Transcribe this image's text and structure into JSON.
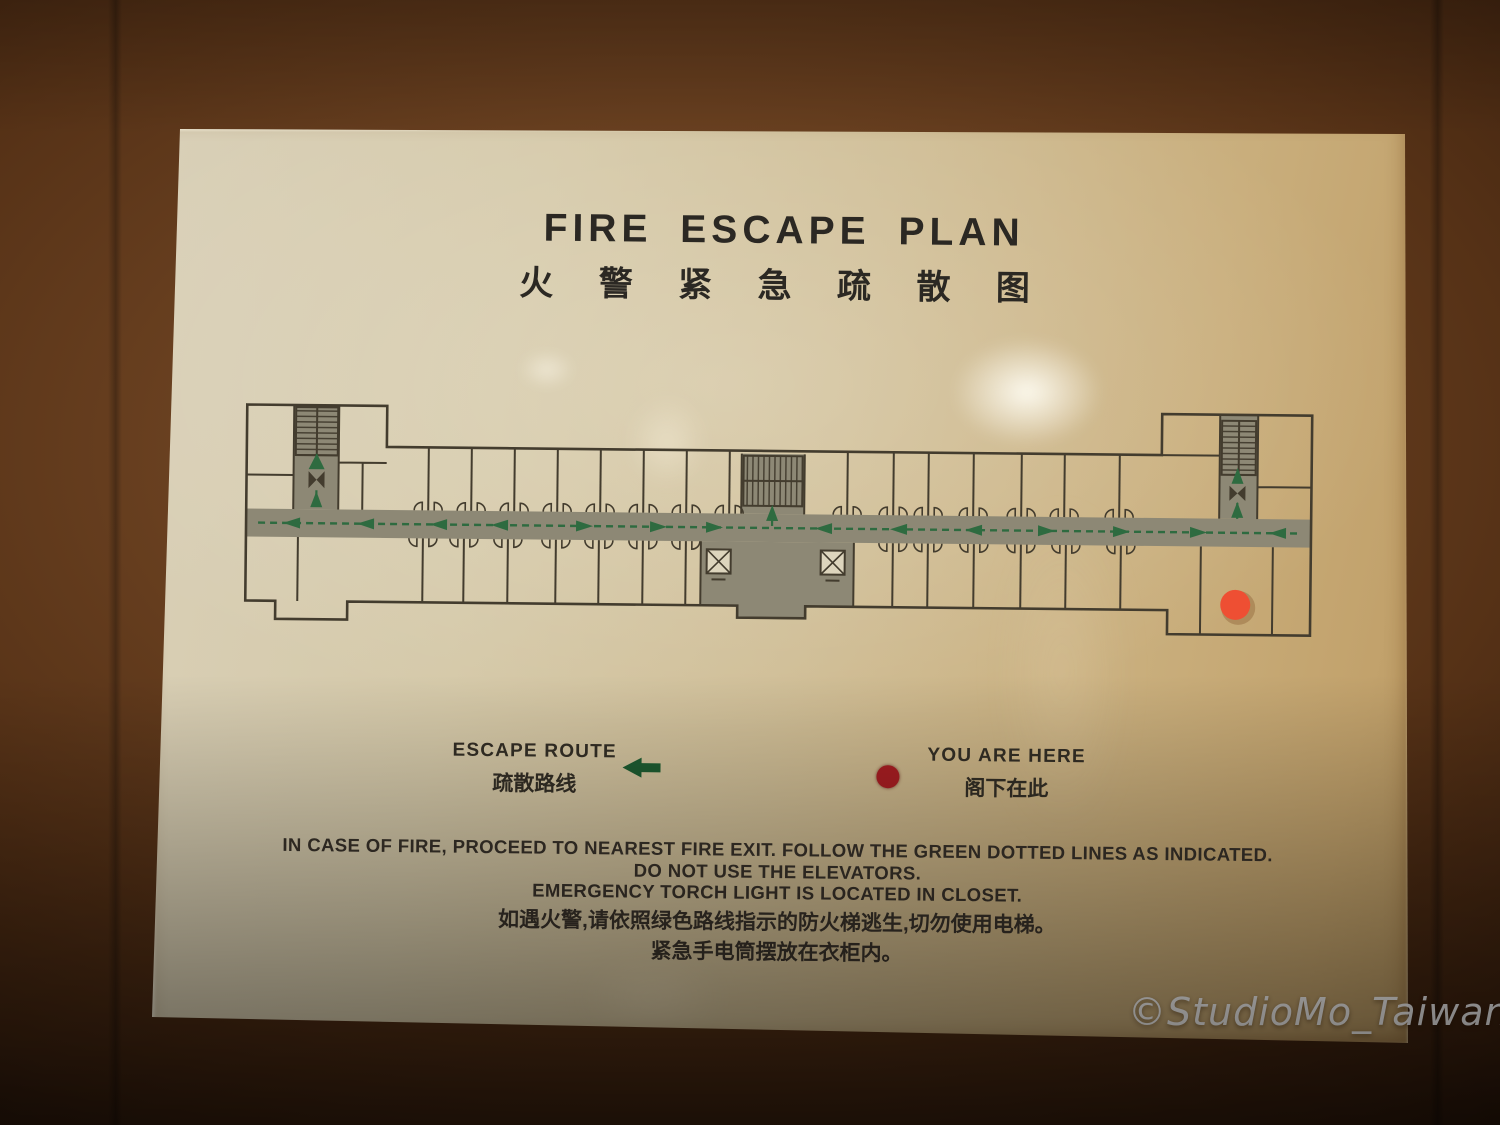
{
  "photo": {
    "watermark_text": "©StudioMo_Taiwan"
  },
  "sign": {
    "title_en": "FIRE ESCAPE PLAN",
    "title_zh": "火 警 紧 急 疏 散 图",
    "legend": {
      "escape_route_en": "ESCAPE ROUTE",
      "escape_route_zh": "疏散路线",
      "you_are_here_en": "YOU ARE HERE",
      "you_are_here_zh": "阁下在此"
    },
    "instructions_en": [
      "IN CASE OF FIRE, PROCEED TO NEAREST FIRE EXIT. FOLLOW THE GREEN DOTTED LINES AS INDICATED.",
      "DO NOT USE THE ELEVATORS.",
      "EMERGENCY TORCH LIGHT IS LOCATED IN CLOSET."
    ],
    "instructions_zh": [
      "如遇火警,请依照绿色路线指示的防火梯逃生,切勿使用电梯。",
      "紧急手电筒摆放在衣柜内。"
    ],
    "colors": {
      "route_green": "#2e6b40",
      "legend_arrow_green": "#1d5c31",
      "legend_marker_red": "#a81e22",
      "plan_marker_red": "#ee4f33",
      "plan_wall": "#433c2e",
      "plan_corridor_gray": "#8d8875"
    }
  },
  "floor_plan": {
    "stairwells": [
      "left",
      "center",
      "right"
    ],
    "elevator_count": 2,
    "corridor_arrows": [
      {
        "x": 54,
        "dir": "left"
      },
      {
        "x": 128,
        "dir": "left"
      },
      {
        "x": 201,
        "dir": "left"
      },
      {
        "x": 262,
        "dir": "left"
      },
      {
        "x": 346,
        "dir": "right"
      },
      {
        "x": 420,
        "dir": "right"
      },
      {
        "x": 476,
        "dir": "right"
      },
      {
        "x": 586,
        "dir": "left"
      },
      {
        "x": 661,
        "dir": "left"
      },
      {
        "x": 736,
        "dir": "left"
      },
      {
        "x": 808,
        "dir": "right"
      },
      {
        "x": 883,
        "dir": "right"
      },
      {
        "x": 960,
        "dir": "right"
      },
      {
        "x": 1040,
        "dir": "left"
      }
    ],
    "branch_arrows": [
      {
        "x": 78,
        "y": 103
      },
      {
        "x": 534,
        "y": 112
      },
      {
        "x": 999,
        "y": 104
      },
      {
        "x": 999,
        "y": 70
      }
    ],
    "upper_walls": [
      190,
      233,
      276,
      319,
      362,
      405,
      448,
      491,
      609,
      655,
      690,
      735,
      783,
      826,
      881
    ],
    "lower_walls": [
      60,
      185,
      226,
      270,
      318,
      361,
      405,
      448,
      655,
      690,
      736,
      783,
      828,
      883
    ]
  }
}
